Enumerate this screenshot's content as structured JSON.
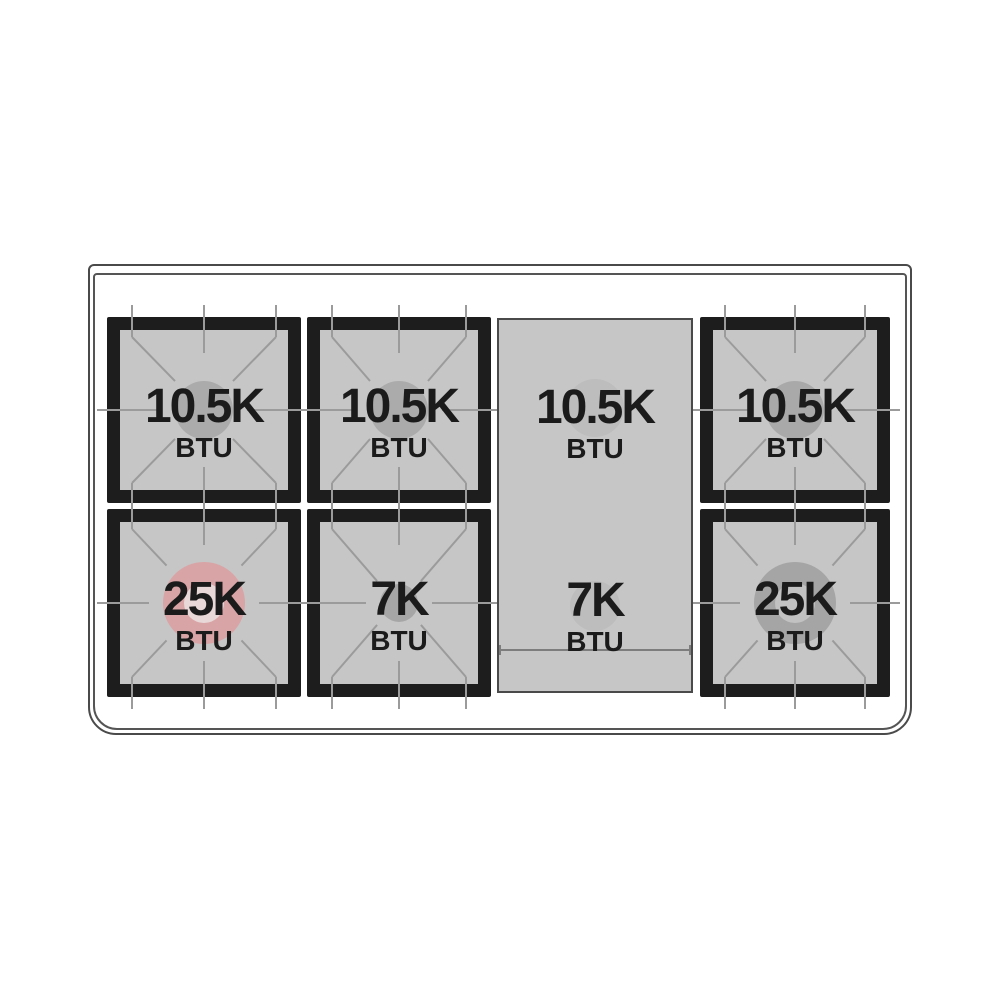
{
  "diagram": {
    "kind": "range-cooktop-burner-layout",
    "colors": {
      "body_outline": "#4a4a4a",
      "grate_frame": "#1d1d1d",
      "burner_bed": "#c6c6c7",
      "grate_lines": "#9b9b9b",
      "text": "#1b1b1b",
      "highlight_pink": "#d9a4a6"
    },
    "burners": [
      {
        "position": "rear-left",
        "value": "10.5K",
        "unit": "BTU",
        "circle": "#ababab",
        "hole": ""
      },
      {
        "position": "rear-center-left",
        "value": "10.5K",
        "unit": "BTU",
        "circle": "#ababab",
        "hole": ""
      },
      {
        "position": "rear-right",
        "value": "10.5K",
        "unit": "BTU",
        "circle": "#a9a9a9",
        "hole": ""
      },
      {
        "position": "front-left",
        "value": "25K",
        "unit": "BTU",
        "circle": "#d9a4a6",
        "hole": "#e9d8d8"
      },
      {
        "position": "front-center-left",
        "value": "7K",
        "unit": "BTU",
        "circle": "#a6a6a6",
        "hole": ""
      },
      {
        "position": "front-right",
        "value": "25K",
        "unit": "BTU",
        "circle": "#a5a5a5",
        "hole": "#c2c2c2"
      }
    ],
    "griddle": {
      "rear": {
        "value": "10.5K",
        "unit": "BTU",
        "circle": "#bdbdbd"
      },
      "front": {
        "value": "7K",
        "unit": "BTU",
        "circle": "#bdbdbd"
      }
    }
  }
}
